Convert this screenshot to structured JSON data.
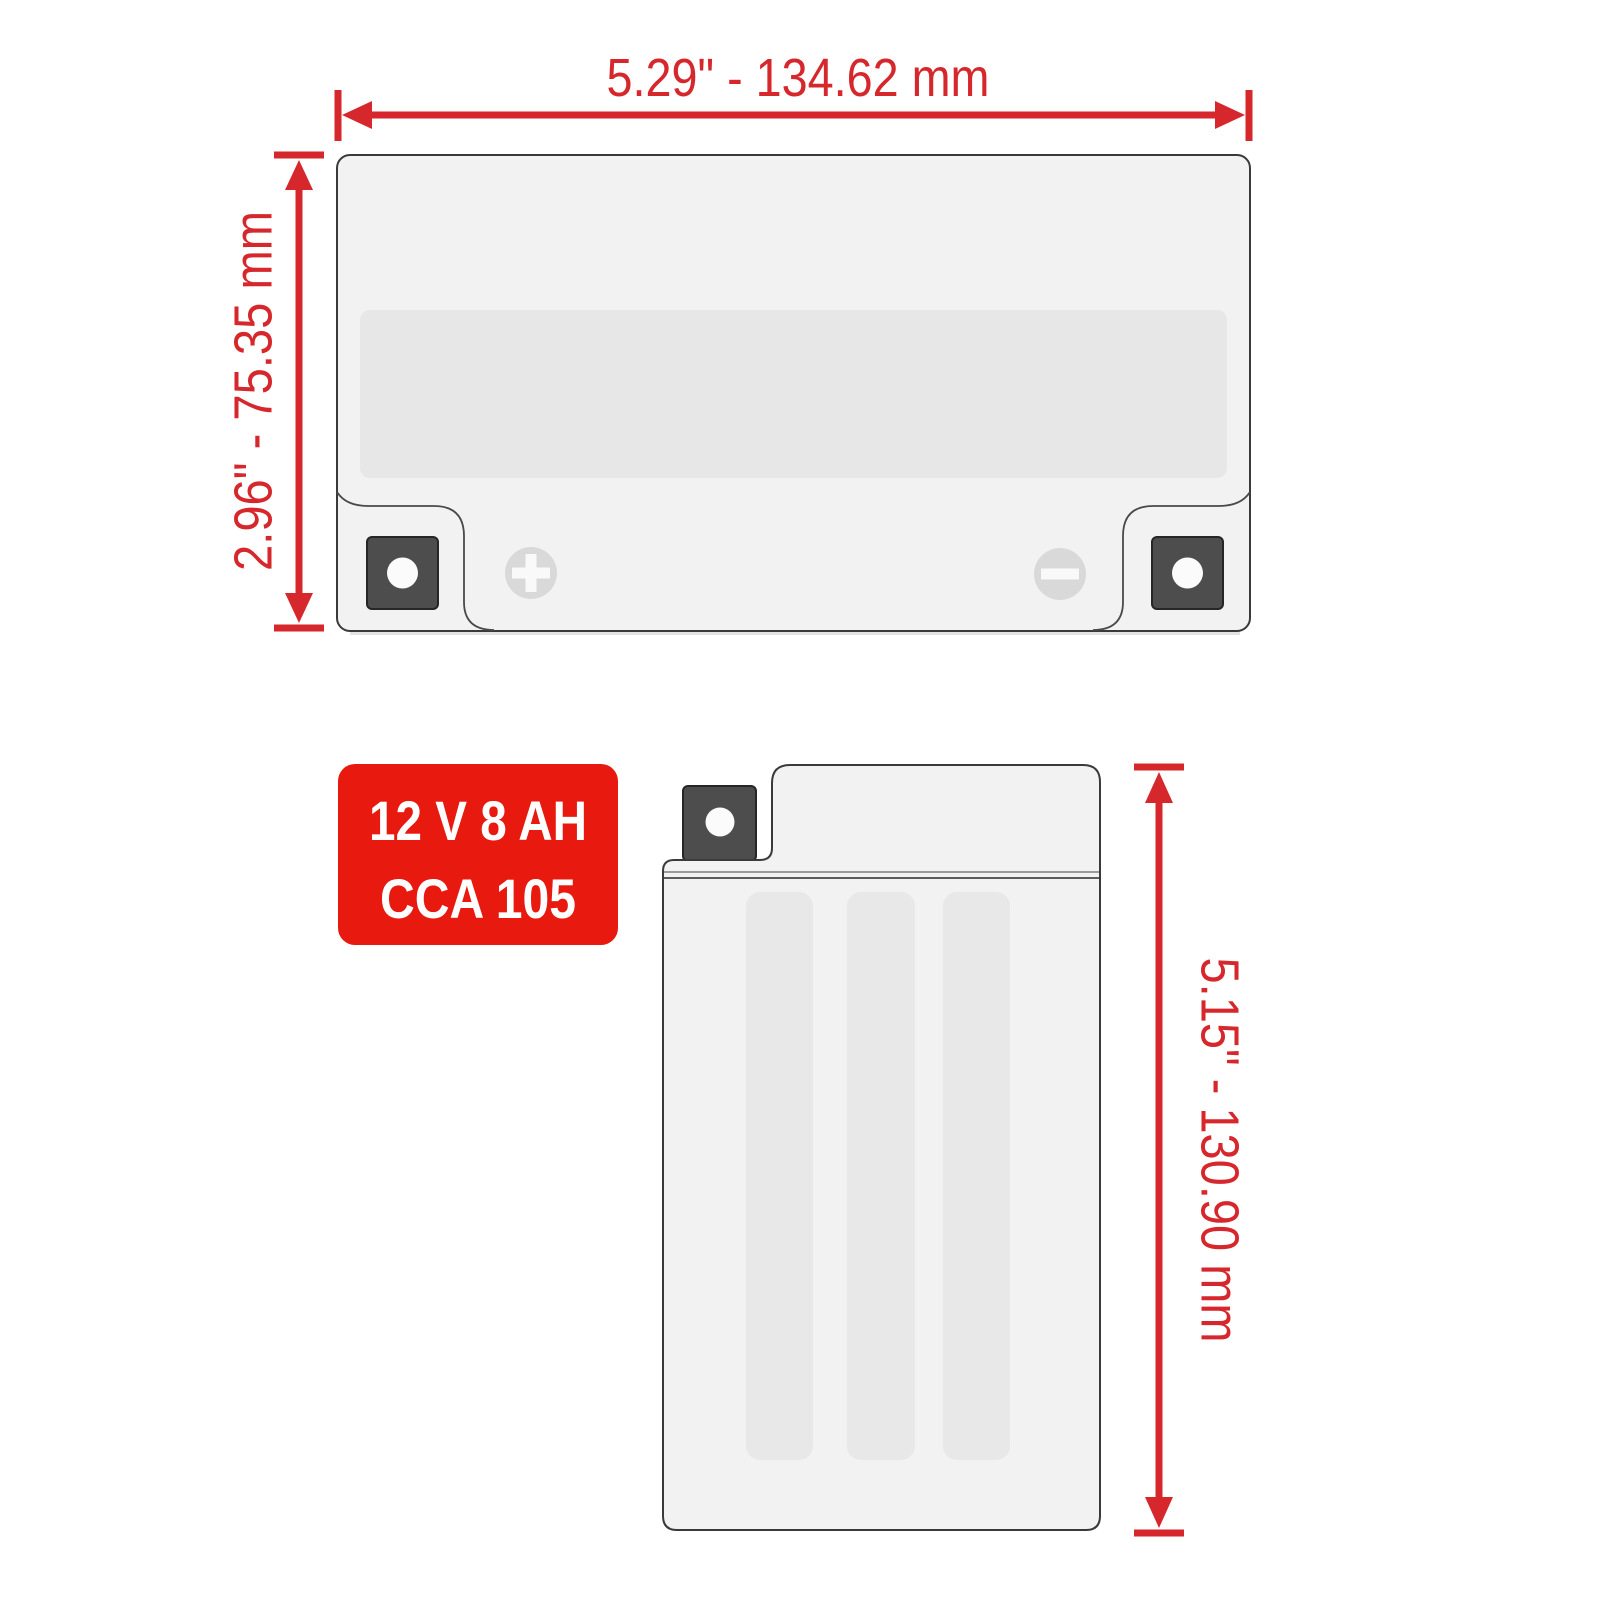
{
  "title": "Battery dimensions diagram",
  "dimensions": {
    "width_front": {
      "label": "5.29\" - 134.62 mm"
    },
    "height_front": {
      "label": "2.96\" - 75.35 mm"
    },
    "height_side": {
      "label": "5.15\" - 130.90 mm"
    }
  },
  "badge": {
    "line1": "12 V  8 AH",
    "line2": "CCA  105"
  },
  "icons": {
    "positive_terminal": "plus-icon",
    "negative_terminal": "minus-icon",
    "front_mount_holes": "circle-hole-icon",
    "side_mount_hole": "circle-hole-icon"
  },
  "colors": {
    "dimension_red": "#d6272c",
    "badge_red": "#e8190f",
    "body_fill": "#f2f2f2",
    "label_strip_fill": "#e7e7e7",
    "stripe_fill": "#e8e8e8",
    "bracket_dark": "#4d4d4d",
    "outline": "#3a3a3a"
  }
}
